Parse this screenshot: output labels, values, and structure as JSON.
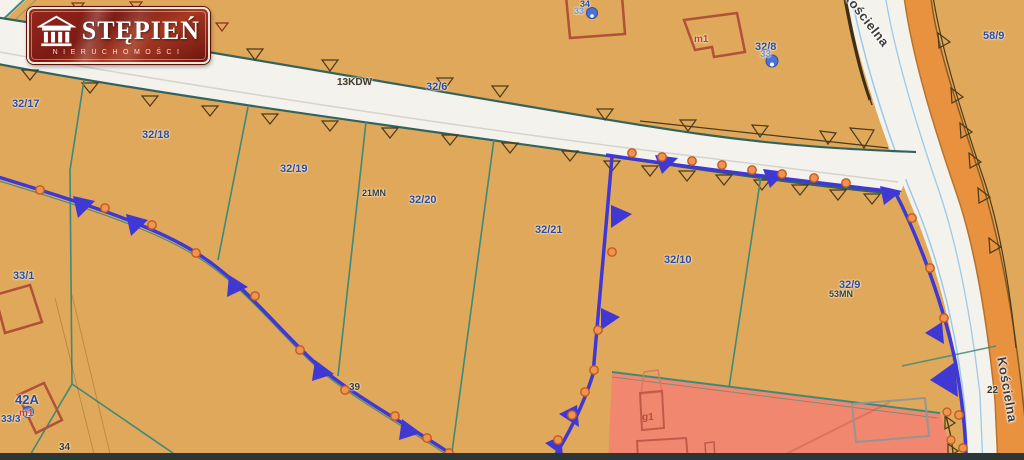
{
  "logo": {
    "title": "STĘPIEŃ",
    "subtitle": "NIERUCHOMOŚCI"
  },
  "labels": {
    "parcel_32_17": "32/17",
    "parcel_32_18": "32/18",
    "parcel_32_19": "32/19",
    "parcel_32_20": "32/20",
    "parcel_32_21": "32/21",
    "parcel_32_10": "32/10",
    "parcel_32_9": "32/9",
    "parcel_32_8": "32/8",
    "parcel_32_6": "32/6",
    "parcel_33_1": "33/1",
    "parcel_33_3": "33/3",
    "parcel_58_9": "58/9",
    "parcel_34": "34",
    "zone_13kdw": "13KDW",
    "zone_21mn": "21MN",
    "zone_53mn": "53MN",
    "zone_39": "39",
    "zone_22": "22",
    "building_m1_top": "m1",
    "building_m1_bottom": "m1",
    "building_g1": "g1",
    "addr_42a": "42A",
    "addr_33_right": "33",
    "addr_34_top": "34",
    "addr_33_top": "33",
    "street_koscielna_top": "Kościelna",
    "street_koscielna_bottom": "Kościelna"
  },
  "palette": {
    "land": "#e0a85a",
    "road": "#f4f2ed",
    "road_edge": "#33635c",
    "boundary_teal": "#3d8a7a",
    "zone_blue": "#4038d2",
    "dot_orange": "#ef9350",
    "sidewalk_orange": "#e8913e",
    "zone_pink": "#f1876e",
    "building_red": "#b05138",
    "label_blue": "#2b4aa2",
    "logo_red": "#8c231b"
  }
}
